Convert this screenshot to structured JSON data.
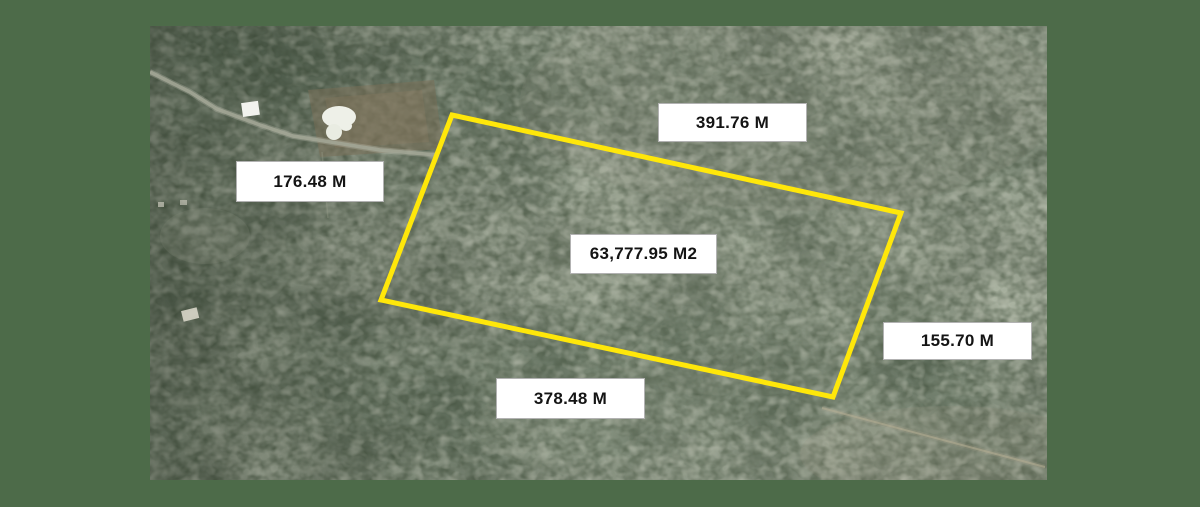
{
  "map": {
    "kind": "satellite-aerial-parcel-view",
    "frame_color": "#4D6B49",
    "parcel": {
      "area_label": "63,777.95 M2",
      "side_measurements": {
        "top": "391.76 M",
        "left": "176.48 M",
        "right": "155.70 M",
        "bottom": "378.48 M"
      },
      "outline_color": "#FFE70A",
      "outline_stroke_width": "5",
      "outline_points": "302,89 751,187 683,371 231,274"
    },
    "label_style": {
      "background": "#FFFFFF",
      "text_color": "#141414"
    },
    "features": {
      "road": "dirt-road-upper-left",
      "clearing": "cleared-lot-with-pool-upper-left",
      "trail": "faint-trail-lower-right"
    }
  }
}
